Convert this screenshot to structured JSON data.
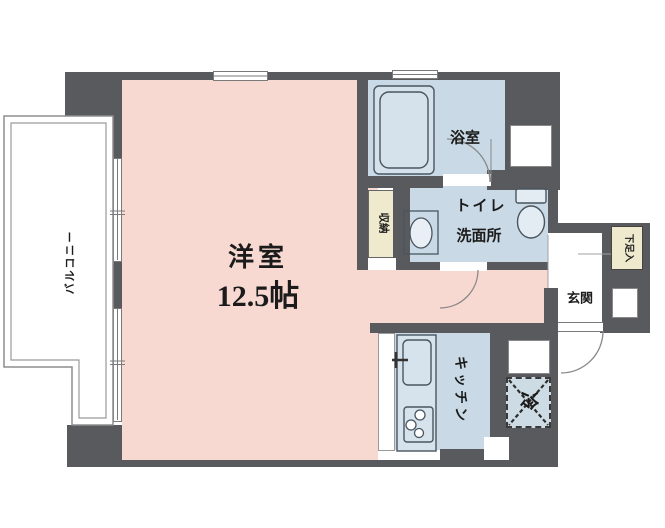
{
  "plan": {
    "type": "apartment-floor-plan",
    "rooms": {
      "western_room": {
        "label": "洋室",
        "size": "12.5帖"
      },
      "bathroom": {
        "label": "浴室"
      },
      "toilet_washroom": {
        "label_line1": "トイレ",
        "label_line2": "洗面所"
      },
      "kitchen": {
        "label": "キッチン"
      },
      "entrance": {
        "label": "玄関"
      },
      "balcony": {
        "label": "バルコニー"
      },
      "storage": {
        "label": "収納"
      },
      "shoe_cabinet": {
        "label": "下足入"
      },
      "refrigerator_space": {
        "label": "冷"
      }
    },
    "colors": {
      "wall": "#595a5e",
      "western_room_fill": "#f8d9d2",
      "wet_area_fill": "#c9dae6",
      "storage_fill": "#efeace",
      "background": "#ffffff"
    }
  }
}
